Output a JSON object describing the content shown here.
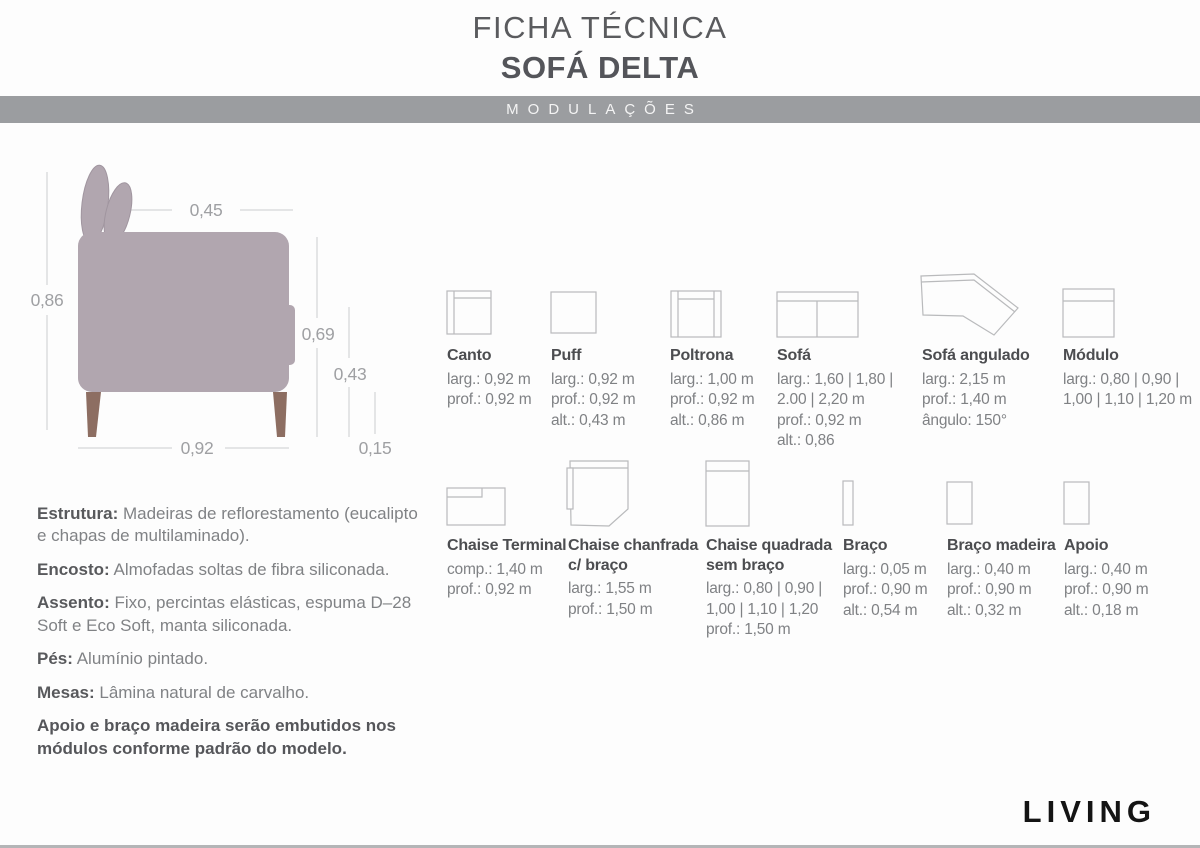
{
  "header": {
    "title_line1": "FICHA TÉCNICA",
    "title_line2": "SOFÁ DELTA",
    "band_label": "MODULAÇÕES"
  },
  "diagram": {
    "dim_top_width": "0,45",
    "dim_total_height": "0,86",
    "dim_back_height": "0,69",
    "dim_seat_height": "0,43",
    "dim_total_depth": "0,92",
    "dim_leg_height": "0,15"
  },
  "modules_row1": [
    {
      "name": "Canto",
      "specs": [
        "larg.: 0,92 m",
        "prof.: 0,92 m"
      ]
    },
    {
      "name": "Puff",
      "specs": [
        "larg.: 0,92 m",
        "prof.: 0,92 m",
        "alt.: 0,43 m"
      ]
    },
    {
      "name": "Poltrona",
      "specs": [
        "larg.: 1,00 m",
        "prof.: 0,92 m",
        "alt.: 0,86 m"
      ]
    },
    {
      "name": "Sofá",
      "specs": [
        "larg.: 1,60 | 1,80 |",
        "2.00 | 2,20 m",
        "prof.: 0,92 m",
        "alt.: 0,86"
      ]
    },
    {
      "name": "Sofá angulado",
      "specs": [
        "larg.: 2,15 m",
        "prof.: 1,40 m",
        "ângulo: 150°"
      ]
    },
    {
      "name": "Módulo",
      "specs": [
        "larg.: 0,80 | 0,90 |",
        "1,00 | 1,10 | 1,20 m"
      ]
    }
  ],
  "modules_row2": [
    {
      "name": "Chaise Terminal",
      "specs": [
        "comp.: 1,40 m",
        "prof.: 0,92 m"
      ]
    },
    {
      "name": "Chaise chanfrada\nc/ braço",
      "specs": [
        "larg.: 1,55 m",
        "prof.: 1,50 m"
      ]
    },
    {
      "name": "Chaise quadrada\nsem braço",
      "specs": [
        "larg.: 0,80 | 0,90 |",
        "1,00 | 1,10 | 1,20",
        "prof.: 1,50 m"
      ]
    },
    {
      "name": "Braço",
      "specs": [
        "larg.: 0,05 m",
        "prof.: 0,90 m",
        "alt.: 0,54 m"
      ]
    },
    {
      "name": "Braço madeira",
      "specs": [
        "larg.: 0,40 m",
        "prof.: 0,90 m",
        "alt.: 0,32 m"
      ]
    },
    {
      "name": "Apoio",
      "specs": [
        "larg.: 0,40 m",
        "prof.: 0,90 m",
        "alt.: 0,18 m"
      ]
    }
  ],
  "specs_text": [
    {
      "label": "Estrutura:",
      "text": " Madeiras de reflorestamento (eucalipto e chapas de multilaminado)."
    },
    {
      "label": "Encosto:",
      "text": " Almofadas soltas de fibra siliconada."
    },
    {
      "label": "Assento:",
      "text": " Fixo, percintas elásticas, espuma D–28 Soft e Eco Soft, manta siliconada."
    },
    {
      "label": "Pés:",
      "text": " Alumínio pintado."
    },
    {
      "label": "Mesas:",
      "text": " Lâmina natural de carvalho."
    },
    {
      "label": "",
      "text": "Apoio e braço madeira serão embutidos nos módulos conforme padrão do modelo."
    }
  ],
  "footer": {
    "brand": "LIVING"
  },
  "colors": {
    "band_gray": "#9b9da0",
    "sofa_body": "#b1a6af",
    "sofa_leg": "#8d6e62",
    "icon_outline": "#b9babc",
    "label_dark": "#4c4d50",
    "detail_gray": "#7f8184",
    "dim_gray": "#9fa0a3"
  }
}
